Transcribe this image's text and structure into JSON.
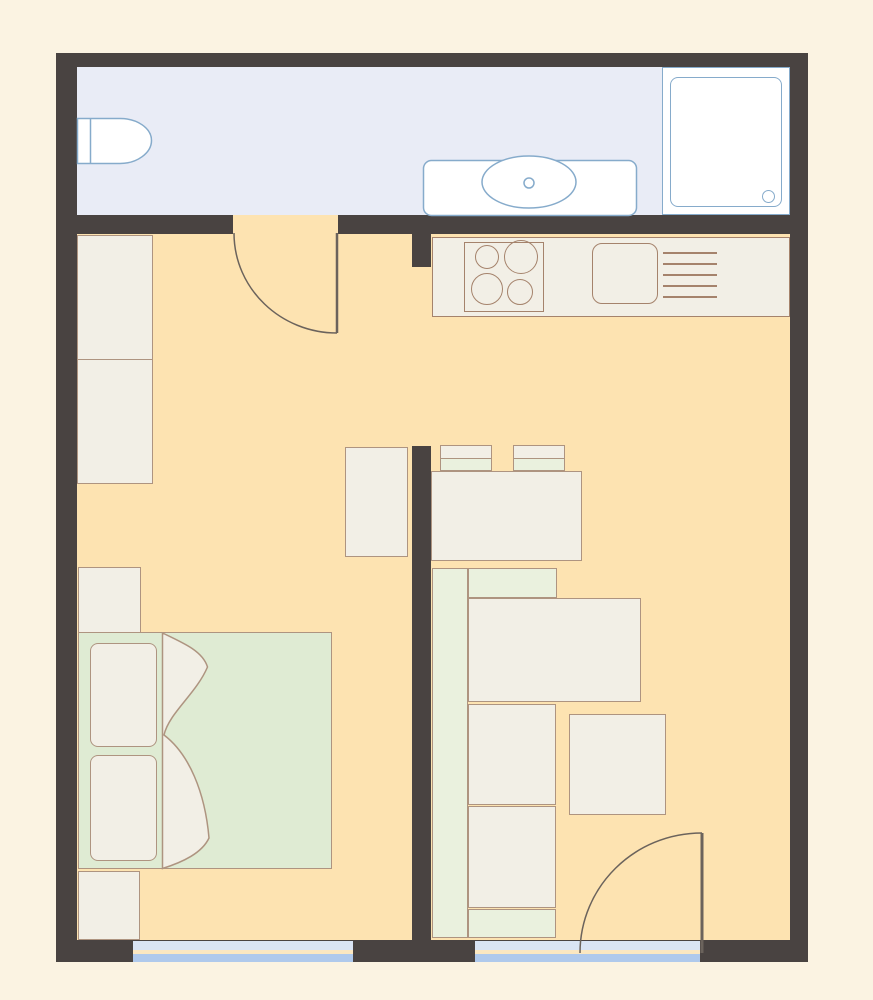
{
  "title": "Apartment floor plan",
  "palette": {
    "background": "#FBF3E2",
    "wall": "#494341",
    "bathroom_floor": "#E9ECF6",
    "room_floor": "#FDE3B1",
    "furniture_fill": "#F2EFE6",
    "furniture_stroke": "#AE9480",
    "upholstery_green": "#EAF1DE",
    "mattress_green": "#DFEBD3",
    "appliance_stroke": "#A5836C",
    "sanitary_stroke": "#86ABCB",
    "sanitary_fill": "#FFFFFF",
    "window_light_blue": "#D9E4F4",
    "window_blue": "#AFC9EC",
    "window_sill": "#FBE7C1",
    "door_stroke": "#6B635C"
  },
  "rooms": [
    {
      "name": "bathroom",
      "floor": "lavender",
      "fixtures": [
        "toilet",
        "washbasin",
        "shower-tray"
      ]
    },
    {
      "name": "bedroom",
      "floor": "peach",
      "furniture": [
        "wardrobe-two-section",
        "nightstand",
        "double-bed-with-pillows-and-blanket",
        "nightstand",
        "dresser"
      ]
    },
    {
      "name": "kitchen-living-room",
      "floor": "peach",
      "furniture": [
        "kitchen-counter",
        "cooktop-four-burners",
        "kitchen-sink",
        "dish-drainer",
        "chair",
        "chair",
        "dining-table",
        "corner-sofa",
        "coffee-table"
      ]
    }
  ],
  "openings": {
    "doors": [
      "bathroom-door",
      "balcony-door"
    ],
    "windows": [
      "bedroom-window",
      "living-room-window"
    ]
  }
}
